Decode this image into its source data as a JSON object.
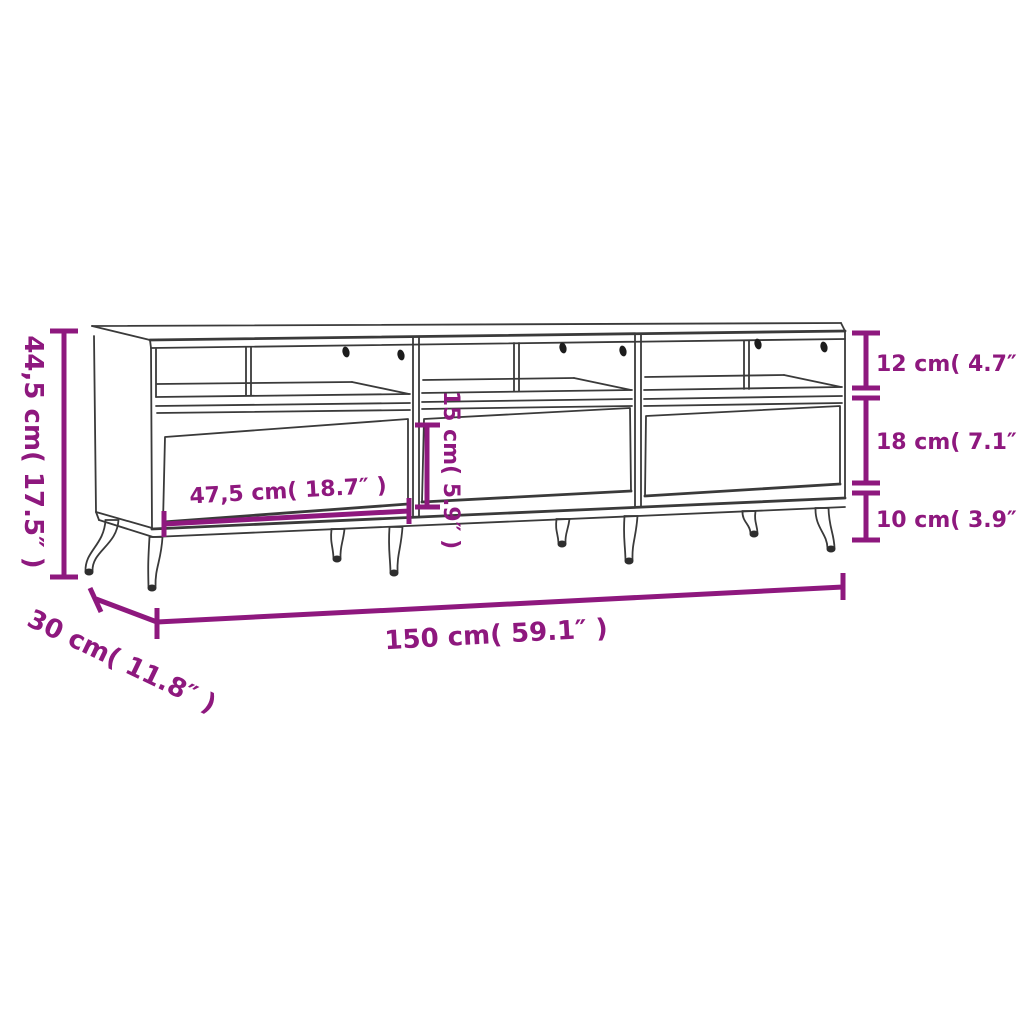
{
  "diagram": {
    "type": "furniture-dimension-diagram",
    "subject": "TV cabinet with three drawers and open compartments on tapered legs",
    "background": "#ffffff",
    "drawing_line_color": "#3a3a3a",
    "accent_color": "#8e187e"
  },
  "dimensions": {
    "height": {
      "label": "44,5 cm( 17.5″ )",
      "value_cm": "44,5",
      "value_in": "17.5",
      "orientation": "vertical-left"
    },
    "compartment_height": {
      "label": "12 cm( 4.7″ )",
      "value_cm": "12",
      "value_in": "4.7",
      "orientation": "vertical-right"
    },
    "drawer_height": {
      "label": "18 cm( 7.1″ )",
      "value_cm": "18",
      "value_in": "7.1",
      "orientation": "vertical-right"
    },
    "leg_height": {
      "label": "10 cm( 3.9″ )",
      "value_cm": "10",
      "value_in": "3.9",
      "orientation": "vertical-right"
    },
    "drawer_width": {
      "label": "47,5 cm( 18.7″ )",
      "value_cm": "47,5",
      "value_in": "18.7",
      "orientation": "horizontal-inner"
    },
    "niche_height": {
      "label": "15 cm( 5.9″ )",
      "value_cm": "15",
      "value_in": "5.9",
      "orientation": "vertical-inner"
    },
    "width": {
      "label": "150 cm( 59.1″ )",
      "value_cm": "150",
      "value_in": "59.1",
      "orientation": "horizontal-bottom"
    },
    "depth": {
      "label": "30 cm( 11.8″ )",
      "value_cm": "30",
      "value_in": "11.8",
      "orientation": "diagonal-bottom"
    }
  }
}
